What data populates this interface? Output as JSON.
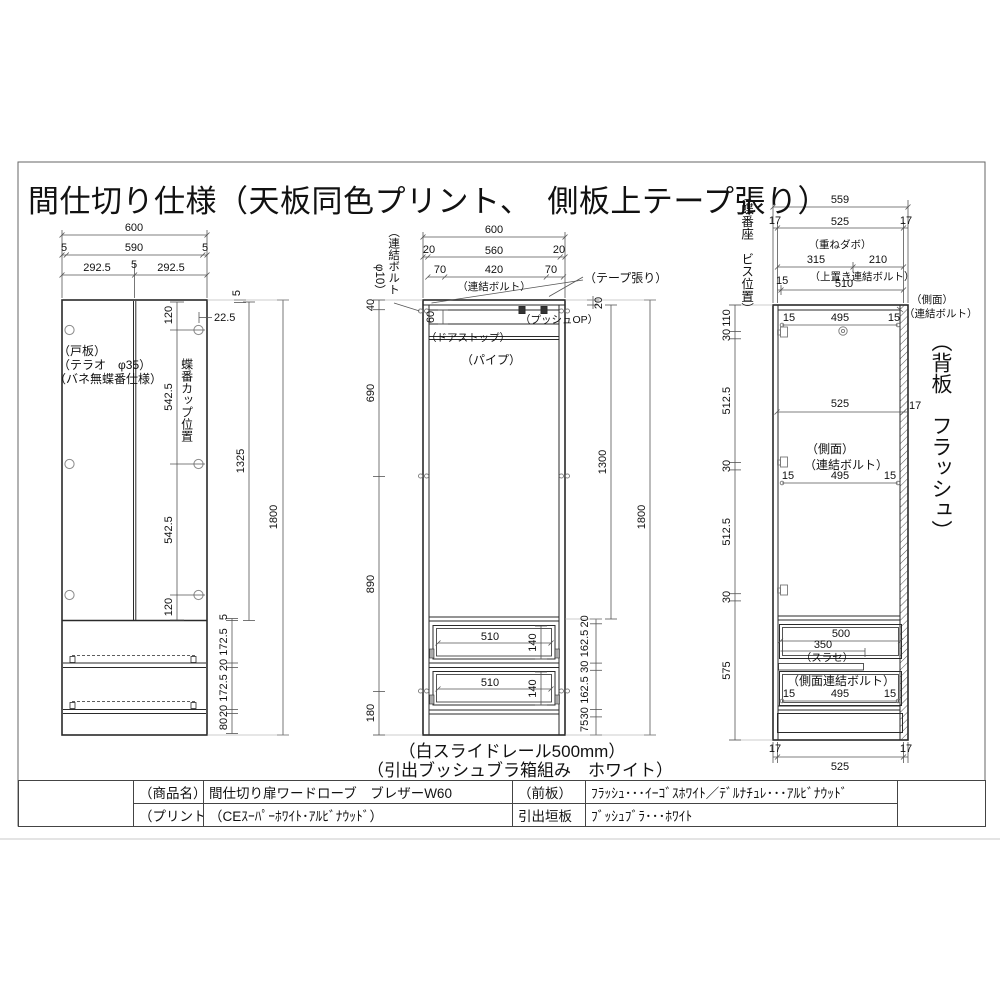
{
  "title": "間仕切り仕様（天板同色プリント、　側板上テープ張り）",
  "left": {
    "w600": "600",
    "w5a": "5",
    "w590": "590",
    "w5b": "5",
    "w292a": "292.5",
    "w5c": "5",
    "w292b": "292.5",
    "d22": "22.5",
    "gap5": "5",
    "v120a": "120",
    "v542a": "542.5",
    "v542b": "542.5",
    "v120b": "120",
    "v1325": "1325",
    "v1800": "1800",
    "b5": "5",
    "b172a": "172.5",
    "b20a": "20",
    "b172b": "172.5",
    "b20b": "20",
    "b80": "80",
    "note1": "（戸板）",
    "note2": "（テラオ　φ35）",
    "note3": "（バネ無蝶番仕様）",
    "hinge_label": "蝶番カップ位置"
  },
  "mid": {
    "w600": "600",
    "w20a": "20",
    "w560": "560",
    "w20b": "20",
    "w70a": "70",
    "w420": "420",
    "w70b": "70",
    "bolt": "（連結ボルト）",
    "boltv1": "（連結ボルト",
    "boltv2": "φ10）",
    "tape": "（テープ張り）",
    "push": "（プッシュOP）",
    "stop": "（ドアストップ）",
    "pipe": "（パイプ）",
    "v40": "40",
    "v690": "690",
    "v890": "890",
    "v180": "180",
    "v60": "60",
    "v20t": "20",
    "v1300": "1300",
    "r20": "20",
    "r162a": "162.5",
    "r30a": "30",
    "r162b": "162.5",
    "r30b": "30",
    "r75": "75",
    "v1800": "1800",
    "d510a": "510",
    "d140a": "140",
    "d510b": "510",
    "d140b": "140",
    "cap1": "（白スライドレール500mm）",
    "cap2": "（引出ブッシュブラ箱組み　ホワイト）"
  },
  "right": {
    "vlabel": "（蝶番座　ビス位置）",
    "back": "（背板　フラッシュ）",
    "w559": "559",
    "w17a": "17",
    "w17b": "17",
    "w525t": "525",
    "kasane": "（重ねダボ）",
    "w315": "315",
    "w210": "210",
    "uwaoki": "（上置き連結ボルト）",
    "w15t": "15",
    "w510": "510",
    "v110": "110",
    "v30a": "30",
    "v512a": "512.5",
    "v30b": "30",
    "v512b": "512.5",
    "v30c": "30",
    "v575": "575",
    "b15a": "15",
    "b495a": "495",
    "b15b": "15",
    "side1a": "（側面）",
    "side1b": "（連結ボルト）",
    "w525m": "525",
    "w17m": "17",
    "side2a": "（側面）",
    "side2b": "（連結ボルト）",
    "b15c": "15",
    "b495b": "495",
    "b15d": "15",
    "w500": "500",
    "w350": "350",
    "surase": "（スラセ）",
    "sideb": "（側面連結ボルト）",
    "b15e": "15",
    "b495c": "495",
    "b15f": "15",
    "w17c": "17",
    "w17d": "17",
    "w525b": "525"
  },
  "table": {
    "r1c1": "（商品名）",
    "r1c2": "間仕切り扉ワードローブ　ブレザーW60",
    "r1c3": "（前板）",
    "r1c4": "ﾌﾗｯｼｭ･･･ｲｰｺﾞｽﾎﾜｲﾄ／ﾃﾞﾙﾅﾁｭﾚ･･･ｱﾙﾋﾞﾅｳｯﾄﾞ",
    "r2c1": "（プリント名）",
    "r2c2": "（CEｽｰﾊﾟｰﾎﾜｲﾄ･ｱﾙﾋﾞﾅｳｯﾄﾞ）",
    "r2c3": "引出垣板",
    "r2c4": "ﾌﾞｯｼｭﾌﾞﾗ･･･ﾎﾜｲﾄ"
  }
}
